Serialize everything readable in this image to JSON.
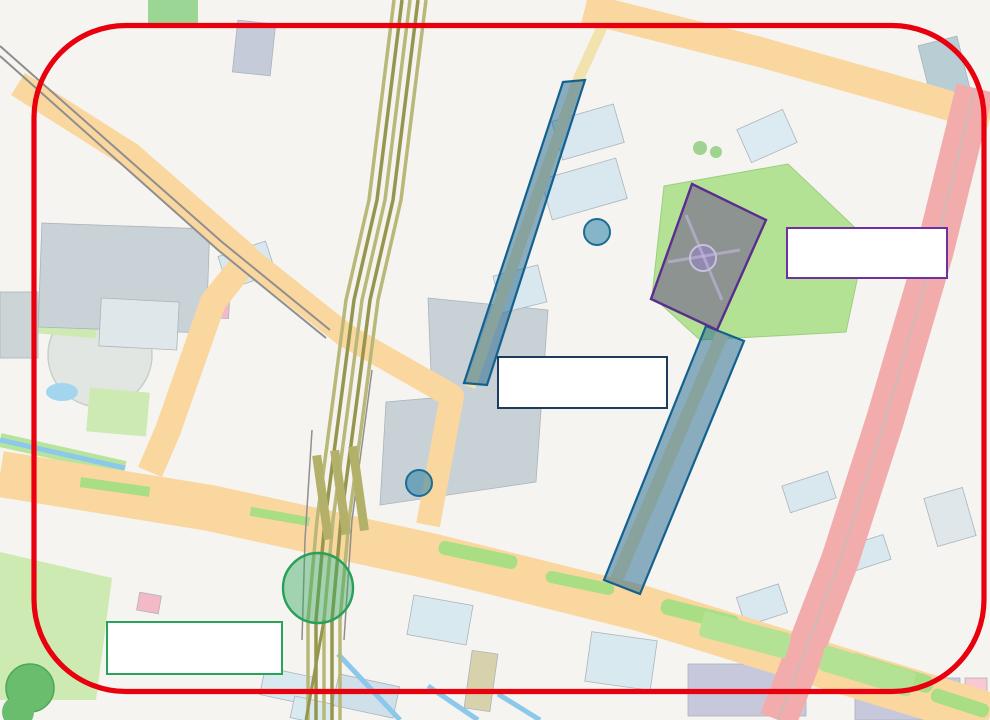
{
  "annotation_boxes": {
    "yokkaichi_box": {
      "line1": "YOKKAICHI WINTER",
      "line2": "ILLUMINATION",
      "border_color": "#1f3a5f"
    },
    "suwa_box": {
      "line1": "すわ公園から",
      "line2": "光の贈りもの",
      "border_color": "#7030a0"
    },
    "asunarou_box": {
      "line1": "四日市あすなろう鉄道",
      "line2": "イルミネーション列車",
      "border_color": "#27a457"
    }
  },
  "highlight_colors": {
    "red_border": "#e8000f",
    "blue_street_highlight": "#1f6f9f",
    "purple_park_highlight": "#6a3fa0",
    "green_station_highlight": "#2eb06a"
  },
  "road_badges": [
    {
      "label": "諏訪町南",
      "x": 823,
      "y": 564
    },
    {
      "label": "諏訪栄町",
      "x": 772,
      "y": 704
    },
    {
      "label": "中部",
      "x": 974,
      "y": 125
    }
  ],
  "route_shields": [
    {
      "number": "1",
      "x": 940,
      "y": 223
    }
  ],
  "poi_icons": [
    {
      "kind": "post-icon",
      "glyph": "ポ",
      "x": 173,
      "y": 43
    },
    {
      "kind": "post-icon",
      "glyph": "ポ",
      "x": 197,
      "y": 210
    },
    {
      "kind": "post-icon",
      "glyph": "ポ",
      "x": 698,
      "y": 316
    },
    {
      "kind": "yakusho-icon",
      "glyph": "役",
      "x": 250,
      "y": 45
    },
    {
      "kind": "yakusho-icon",
      "glyph": "役",
      "x": 935,
      "y": 693
    },
    {
      "kind": "other-icon",
      "glyph": "他",
      "x": 157,
      "y": 172
    },
    {
      "kind": "other-icon",
      "glyph": "他",
      "x": 297,
      "y": 268
    },
    {
      "kind": "other-icon",
      "glyph": "他",
      "x": 29,
      "y": 248
    },
    {
      "kind": "other-icon",
      "glyph": "他",
      "x": 335,
      "y": 714
    },
    {
      "kind": "shop-icon",
      "glyph": "●",
      "x": 185,
      "y": 586,
      "color": "#8d5524"
    },
    {
      "kind": "shop-icon",
      "glyph": "●",
      "x": 375,
      "y": 692,
      "color": "#8d5524"
    },
    {
      "kind": "fountain-icon",
      "glyph": "●",
      "x": 676,
      "y": 287,
      "color": "#2196f3"
    },
    {
      "kind": "circle-marker-icon",
      "glyph": "",
      "x": 732,
      "y": 211
    },
    {
      "kind": "tree-icon",
      "glyph": "♣",
      "x": 58,
      "y": 365,
      "color": "#2e7d32"
    }
  ],
  "map_labels": [
    {
      "text": "西浦公園",
      "x": 175,
      "y": 18
    },
    {
      "text": "西浦1",
      "x": 218,
      "y": 16,
      "cls": "town"
    },
    {
      "text": "四日市労働基準協会",
      "x": 360,
      "y": 22
    },
    {
      "text": "住吉湯",
      "x": 733,
      "y": 7
    },
    {
      "text": "ファミリーマート",
      "x": 575,
      "y": 40
    },
    {
      "text": "中部地区市民センター",
      "x": 250,
      "y": 56
    },
    {
      "text": "快活CLUB",
      "x": 948,
      "y": 71
    },
    {
      "text": "西新地",
      "x": 678,
      "y": 86,
      "cls": "town"
    },
    {
      "text": "コート西浦",
      "x": 342,
      "y": 110
    },
    {
      "text": "料亭みどり",
      "x": 722,
      "y": 135
    },
    {
      "text": "大正館",
      "x": 775,
      "y": 143
    },
    {
      "text": "シティ堀木",
      "x": 423,
      "y": 132
    },
    {
      "text": "天理教会",
      "x": 305,
      "y": 151
    },
    {
      "text": "三十三銀行",
      "x": 587,
      "y": 143
    },
    {
      "text": "エコノ",
      "x": 205,
      "y": 181
    },
    {
      "text": "EST2000",
      "x": 418,
      "y": 199,
      "cls": "gray"
    },
    {
      "text": "プラトンホテル四日市",
      "x": 580,
      "y": 201
    },
    {
      "text": "子供の家",
      "x": 733,
      "y": 218
    },
    {
      "text": "トナリエ四日市",
      "x": 122,
      "y": 253
    },
    {
      "text": "産業振興センター",
      "x": 60,
      "y": 257
    },
    {
      "text": "四日市シティ",
      "x": 452,
      "y": 255
    },
    {
      "text": "クラウンビル",
      "x": 523,
      "y": 249
    },
    {
      "text": "三交イン四日市駅前",
      "x": 247,
      "y": 283
    },
    {
      "text": "諏訪公園",
      "x": 750,
      "y": 283
    },
    {
      "text": "山津見神社",
      "x": 812,
      "y": 281
    },
    {
      "text": "東横INN",
      "x": 542,
      "y": 304
    },
    {
      "text": "諏訪神社",
      "x": 770,
      "y": 312
    },
    {
      "text": "パチンコキング観光",
      "x": 448,
      "y": 314
    },
    {
      "text": "都ホテル四日市",
      "x": 148,
      "y": 323
    },
    {
      "text": "北山心身クリニック",
      "x": 218,
      "y": 324
    },
    {
      "text": "博物館",
      "x": 16,
      "y": 324
    },
    {
      "text": "安島1",
      "x": 103,
      "y": 382,
      "cls": "town"
    },
    {
      "text": "諏訪栄町",
      "x": 668,
      "y": 354,
      "cls": "town"
    },
    {
      "text": "+",
      "x": 648,
      "y": 346,
      "cls": "cross"
    },
    {
      "text": "ファミリーマート",
      "x": 281,
      "y": 414
    },
    {
      "text": "みずほ",
      "x": 234,
      "y": 437
    },
    {
      "text": "近鉄",
      "x": 403,
      "y": 438,
      "cls": "gray"
    },
    {
      "text": "パチンコ&スロットインパルス",
      "x": 515,
      "y": 430
    },
    {
      "text": "パークサイドビル",
      "x": 163,
      "y": 469
    },
    {
      "text": "ジェックSビル",
      "x": 228,
      "y": 470
    },
    {
      "text": "パーラーホームラン",
      "x": 640,
      "y": 476
    },
    {
      "text": "岡三証券",
      "x": 812,
      "y": 502
    },
    {
      "text": "プレミスト",
      "x": 523,
      "y": 511
    },
    {
      "text": "ローレルタワー シュロア四日市",
      "x": 600,
      "y": 518
    },
    {
      "text": "河合塾",
      "x": 563,
      "y": 535
    },
    {
      "text": "サーパス諏訪",
      "x": 956,
      "y": 520
    },
    {
      "text": "三井住友信託",
      "x": 872,
      "y": 558
    },
    {
      "text": "セブンイレブン",
      "x": 848,
      "y": 590
    },
    {
      "text": "野村證券",
      "x": 768,
      "y": 606
    },
    {
      "text": "四日市MNビル",
      "x": 762,
      "y": 632
    },
    {
      "text": "四日市諏訪町ビル",
      "x": 830,
      "y": 643
    },
    {
      "text": "商工会議所",
      "x": 893,
      "y": 684
    },
    {
      "text": "総合会館",
      "x": 944,
      "y": 707
    },
    {
      "text": "アトレ諏訪",
      "x": 970,
      "y": 375
    },
    {
      "text": "住友電装",
      "x": 436,
      "y": 622
    },
    {
      "text": "かに本家",
      "x": 494,
      "y": 643
    },
    {
      "text": "古川学園",
      "x": 495,
      "y": 684
    },
    {
      "text": "JA",
      "x": 547,
      "y": 673
    },
    {
      "text": "三交ビル",
      "x": 593,
      "y": 687
    },
    {
      "text": "山本産婦人科",
      "x": 158,
      "y": 614
    },
    {
      "text": "スーパー",
      "x": 268,
      "y": 605
    },
    {
      "text": "TANIX",
      "x": 186,
      "y": 698,
      "cls": "gray"
    },
    {
      "text": "澄懐堂ビル",
      "x": 285,
      "y": 687
    },
    {
      "text": "サムティ四日市ビル",
      "x": 370,
      "y": 699
    },
    {
      "text": "太陽生命ビル",
      "x": 291,
      "y": 711
    },
    {
      "text": "オリックスレンタカー 萩ビル",
      "x": 92,
      "y": 566
    },
    {
      "text": "レイアホテル四日市",
      "x": 112,
      "y": 540
    },
    {
      "text": "駿英予備校",
      "x": 57,
      "y": 536
    },
    {
      "text": "ニテクプラザ",
      "x": 18,
      "y": 527
    },
    {
      "text": "近鉄四日市駅",
      "x": 344,
      "y": 455,
      "cls": "station"
    },
    {
      "text": "あすなろう四日市駅",
      "x": 340,
      "y": 482,
      "cls": "station"
    },
    {
      "text": "近",
      "x": 93,
      "y": 140,
      "cls": "rail"
    },
    {
      "text": "鉄",
      "x": 122,
      "y": 160,
      "cls": "rail"
    },
    {
      "text": "湯",
      "x": 152,
      "y": 190,
      "cls": "rail"
    },
    {
      "text": "の",
      "x": 178,
      "y": 204,
      "cls": "rail"
    },
    {
      "text": "山",
      "x": 209,
      "y": 223,
      "cls": "rail"
    },
    {
      "text": "線",
      "x": 236,
      "y": 246,
      "cls": "rail"
    },
    {
      "text": "通",
      "x": 21,
      "y": 448,
      "cls": "street"
    },
    {
      "text": "り",
      "x": 55,
      "y": 463,
      "cls": "street"
    },
    {
      "text": "三十三",
      "x": 215,
      "y": 503,
      "cls": "street"
    },
    {
      "text": "西",
      "x": 558,
      "y": 113,
      "cls": "street"
    },
    {
      "text": "通",
      "x": 546,
      "y": 143,
      "cls": "street"
    },
    {
      "text": "ライオン通り",
      "x": 752,
      "y": 485,
      "cls": "street-v"
    },
    {
      "text": "5",
      "x": 30,
      "y": 17,
      "cls": "num"
    },
    {
      "text": "6",
      "x": 126,
      "y": 63,
      "cls": "num"
    },
    {
      "text": "9",
      "x": 224,
      "y": 107,
      "cls": "num"
    },
    {
      "text": "10",
      "x": 159,
      "y": 148,
      "cls": "num"
    },
    {
      "text": "11",
      "x": 302,
      "y": 178,
      "cls": "num"
    },
    {
      "text": "17",
      "x": 925,
      "y": 58,
      "cls": "num"
    },
    {
      "text": "3",
      "x": 773,
      "y": 120,
      "cls": "num"
    },
    {
      "text": "2",
      "x": 842,
      "y": 97,
      "cls": "num"
    },
    {
      "text": "12",
      "x": 633,
      "y": 338,
      "cls": "num"
    },
    {
      "text": "16",
      "x": 733,
      "y": 371,
      "cls": "num"
    },
    {
      "text": "15",
      "x": 719,
      "y": 438,
      "cls": "num"
    },
    {
      "text": "19",
      "x": 754,
      "y": 462,
      "cls": "num"
    },
    {
      "text": "20",
      "x": 805,
      "y": 496,
      "cls": "num"
    }
  ]
}
